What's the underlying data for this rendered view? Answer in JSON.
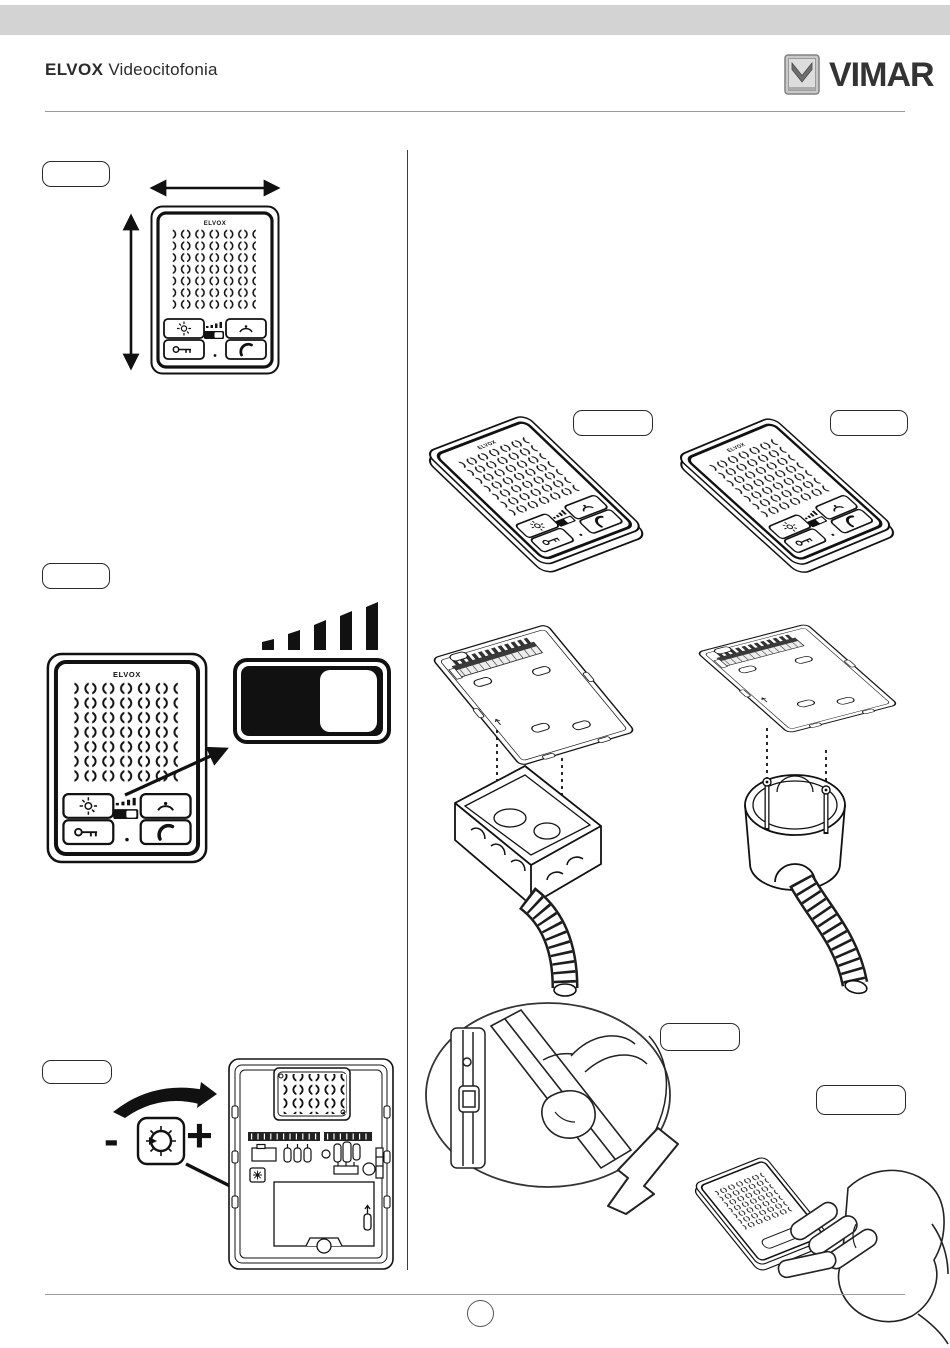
{
  "header": {
    "brand": "ELVOX",
    "subtitle": "Videocitofonia",
    "logo_text": "VIMAR"
  },
  "device": {
    "brand_label": "ELVOX"
  },
  "volume_adjust": {
    "minus_label": "-",
    "plus_label": "+"
  },
  "colors": {
    "top_bar": "#d3d3d3",
    "ink": "#1c1c1c",
    "rule": "#9a9a9a",
    "logo_gray": "#c9c9c9"
  }
}
